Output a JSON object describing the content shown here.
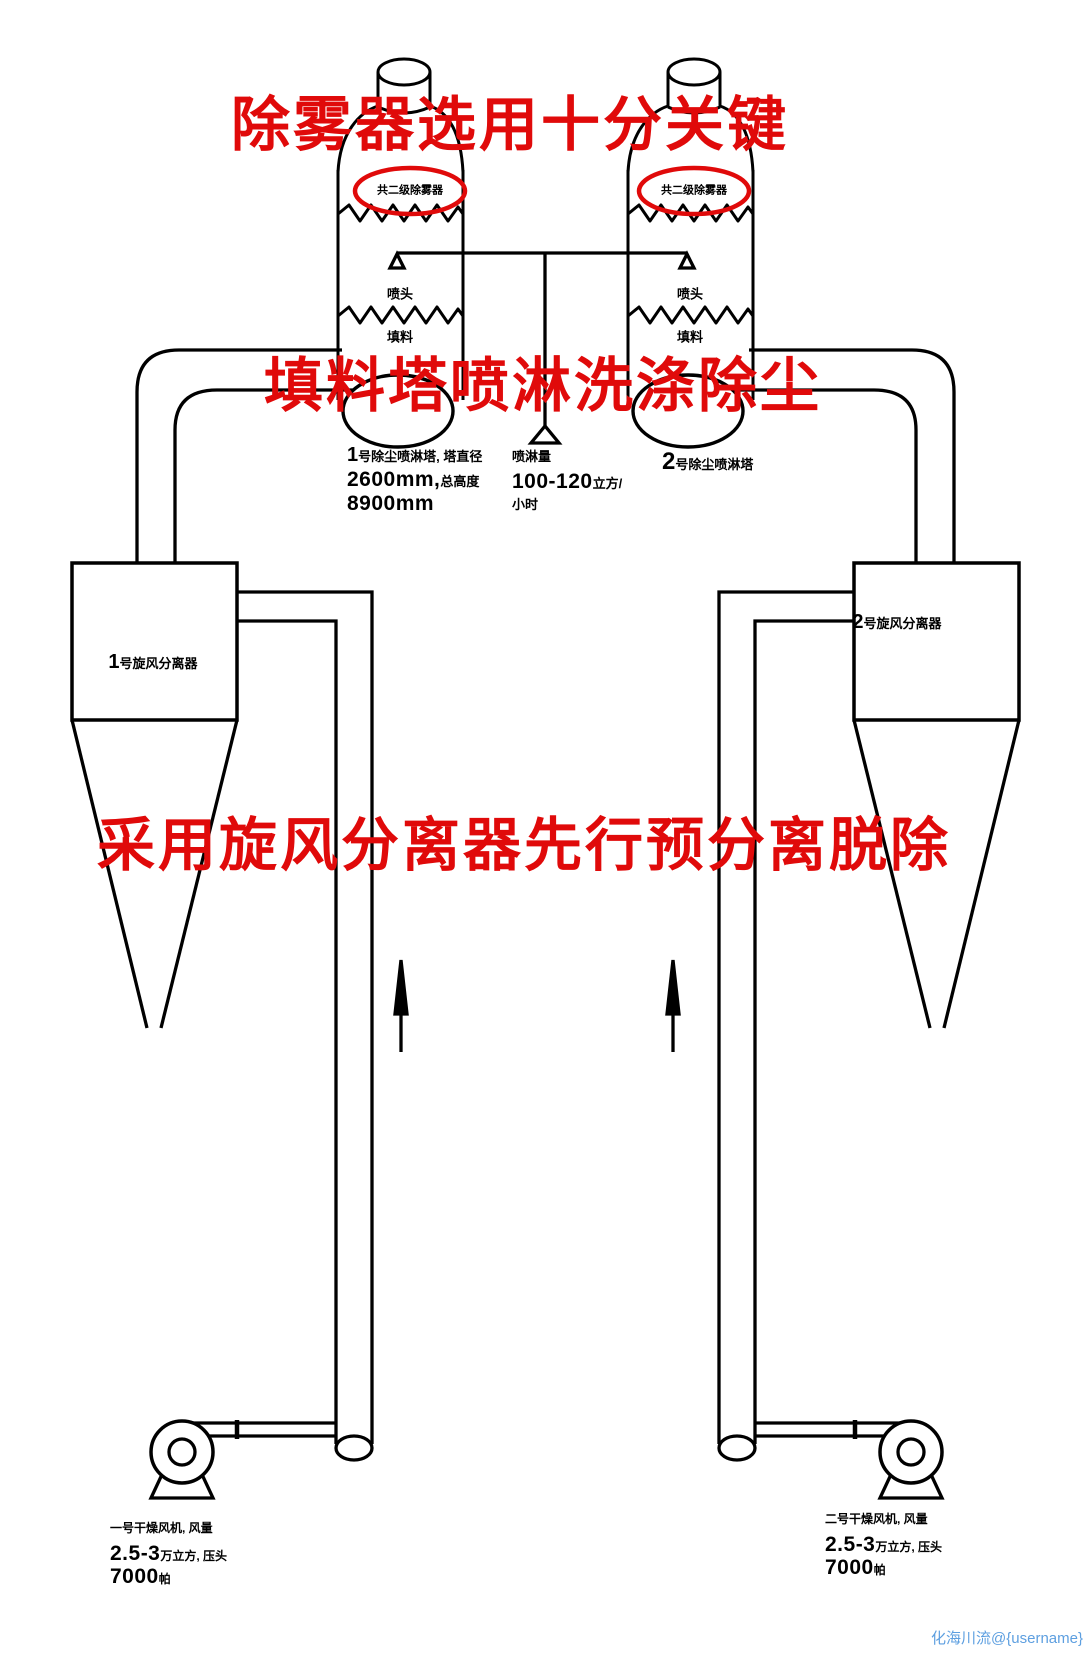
{
  "titles": {
    "top": "除雾器选用十分关键",
    "middle": "填料塔喷淋洗涤除尘",
    "bottom": "采用旋风分离器先行预分离脱除"
  },
  "colors": {
    "annotation_red": "#e00a0a",
    "line_black": "#000000",
    "watermark_blue": "#5d9fe0"
  },
  "towers": {
    "left": {
      "mist_eliminator_note": "共二级除雾器",
      "nozzle_label": "喷头",
      "packing_label": "填料",
      "spec": {
        "no": "1",
        "name_suffix": "号除尘喷淋塔, 塔直径",
        "diameter": "2600mm,",
        "height_label": "总高度",
        "height_value": "8900mm"
      }
    },
    "right": {
      "mist_eliminator_note": "共二级除雾器",
      "nozzle_label": "喷头",
      "packing_label": "填料",
      "spec": {
        "no": "2",
        "name_suffix": "号除尘喷淋塔"
      }
    },
    "spray": {
      "label": "喷淋量",
      "value": "100-120",
      "unit_line1": "立方/",
      "unit_line2": "小时"
    }
  },
  "cyclones": {
    "left": {
      "no": "1",
      "name_suffix": "号旋风分离器"
    },
    "right": {
      "no": "2",
      "name_suffix": "号旋风分离器"
    }
  },
  "fans": {
    "left": {
      "line1": "一号干燥风机, 风量",
      "flow_value": "2.5-3",
      "flow_suffix": "万立方, 压头",
      "pressure_value": "7000",
      "pressure_unit": "帕"
    },
    "right": {
      "line1": "二号干燥风机, 风量",
      "flow_value": "2.5-3",
      "flow_suffix": "万立方, 压头",
      "pressure_value": "7000",
      "pressure_unit": "帕"
    }
  },
  "watermark": "化海川流@{username}"
}
